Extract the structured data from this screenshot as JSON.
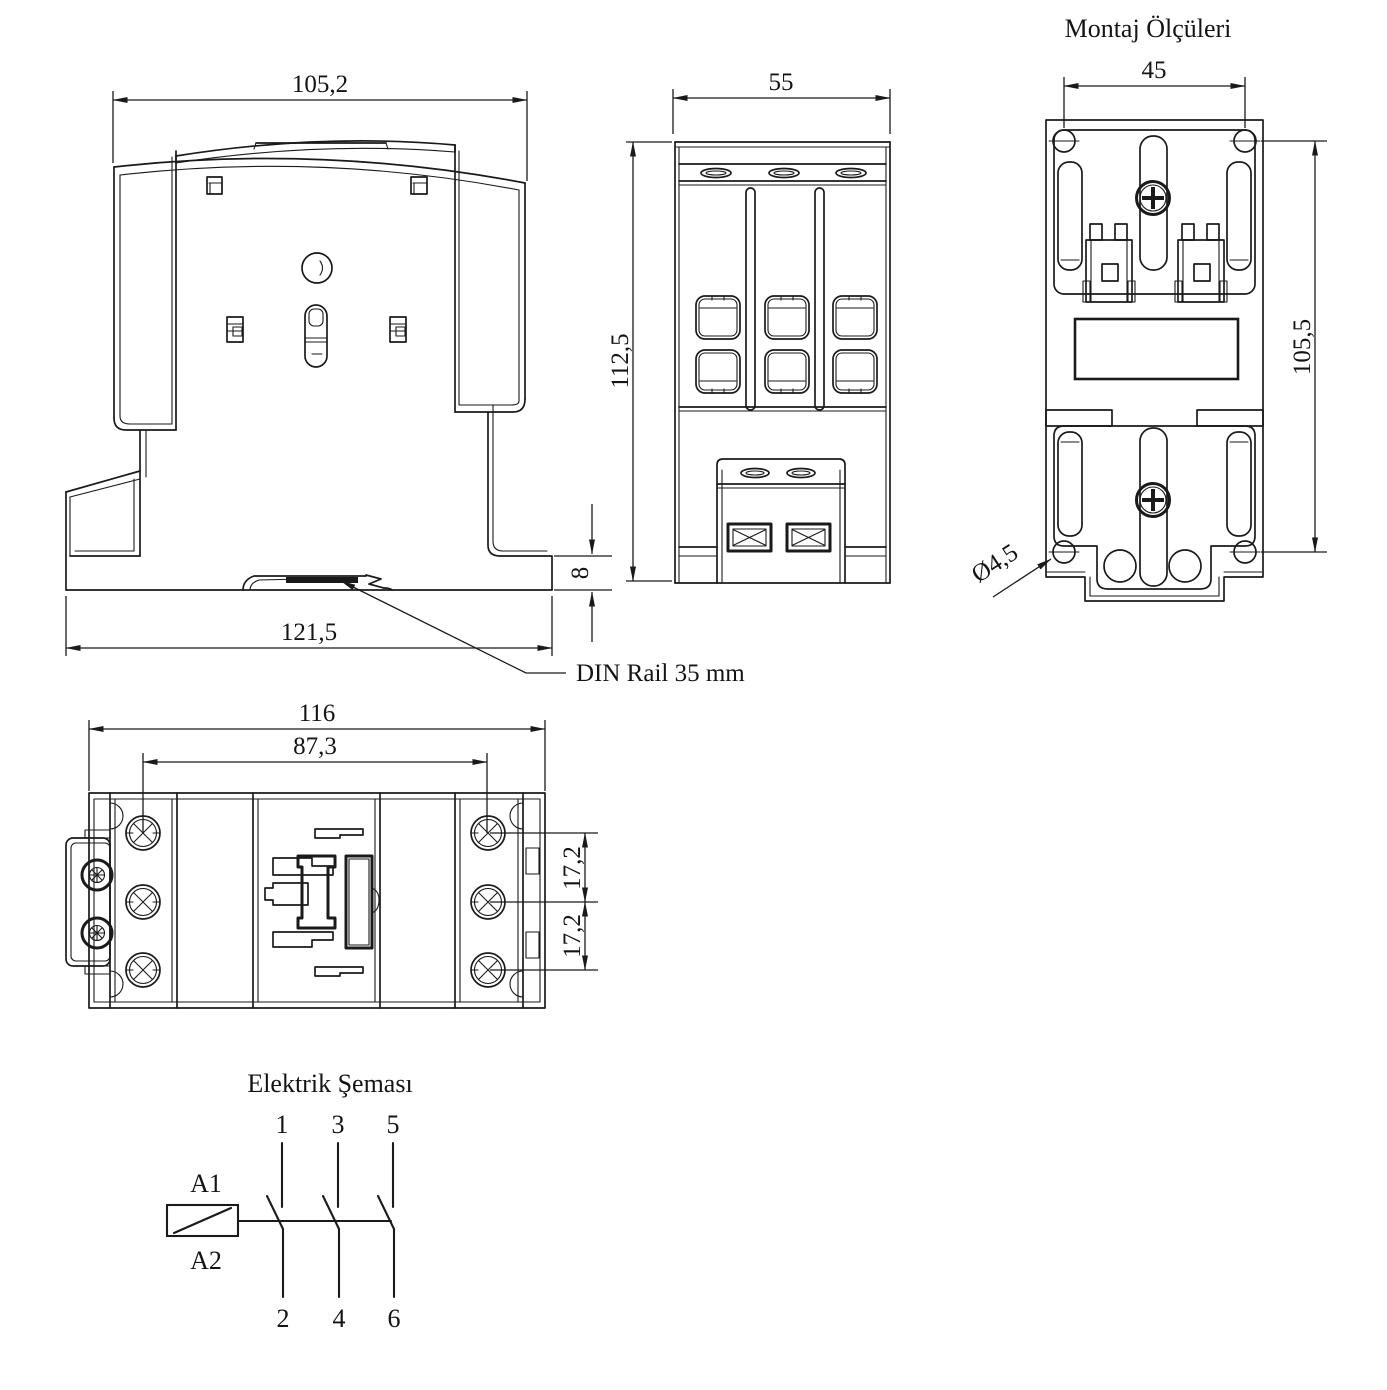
{
  "colors": {
    "line": "#1a1a1a",
    "background": "#ffffff"
  },
  "side_view": {
    "top_width": "105,2",
    "base_width": "121,5",
    "base_height": "8",
    "rail_label": "DIN Rail 35 mm"
  },
  "front_view": {
    "width": "55",
    "height": "112,5"
  },
  "mounting_view": {
    "title": "Montaj Ölçüleri",
    "hole_span_horizontal": "45",
    "hole_span_vertical": "105,5",
    "hole_diameter": "Ø4,5"
  },
  "top_view": {
    "width": "116",
    "screw_span": "87,3",
    "pitch_top": "17,2",
    "pitch_bottom": "17,2"
  },
  "circuit": {
    "title": "Elektrik Şeması",
    "coil_a1": "A1",
    "coil_a2": "A2",
    "contacts": {
      "t1": "1",
      "t2": "2",
      "t3": "3",
      "t4": "4",
      "t5": "5",
      "t6": "6"
    }
  }
}
